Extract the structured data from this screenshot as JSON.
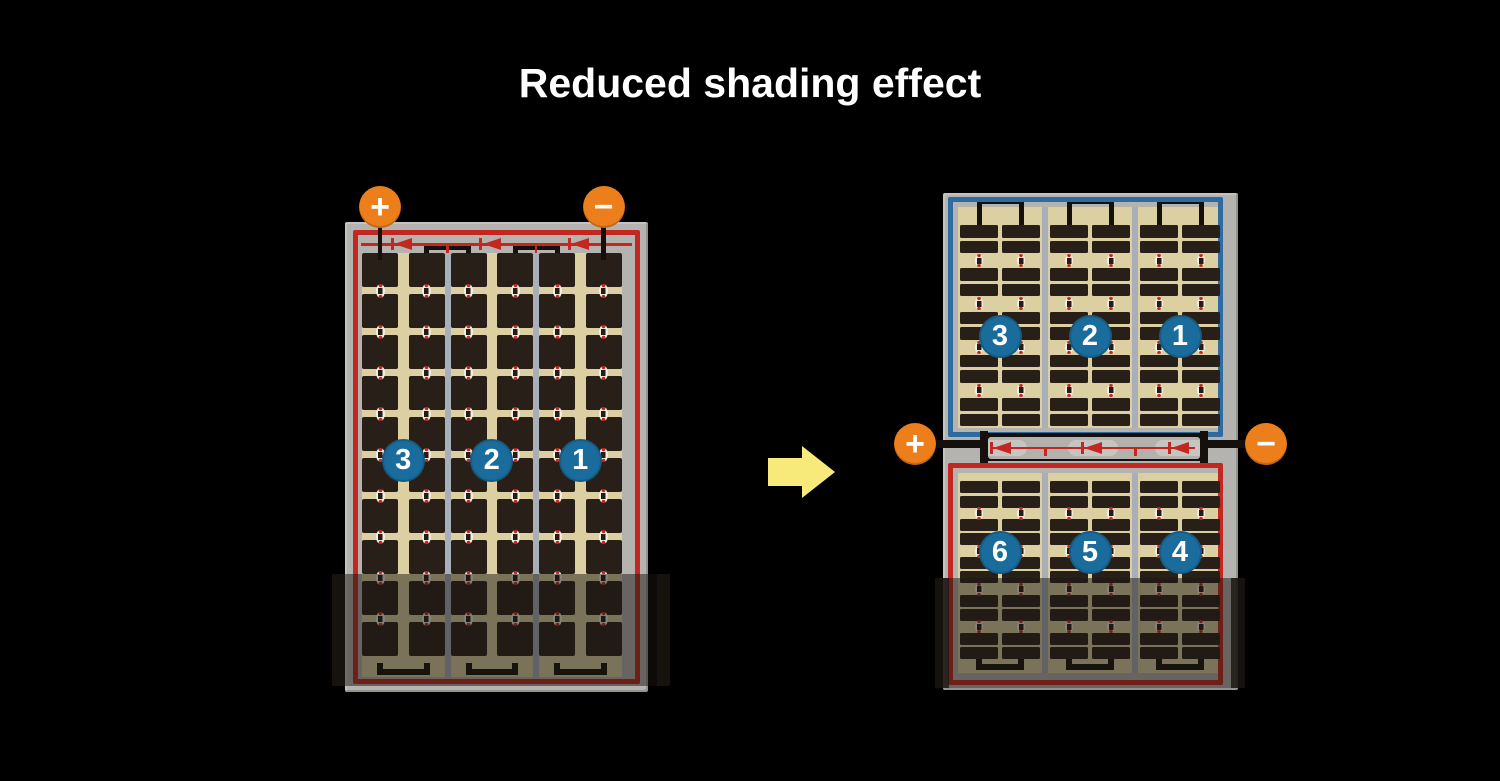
{
  "title": "Reduced shading effect",
  "colors": {
    "background": "#000000",
    "title_text": "#ffffff",
    "frame_gray": "#b5b3b0",
    "junction_gray": "#b3b1ae",
    "junction_module_gray": "#c7c5c2",
    "cell_area_tan": "#dccfa2",
    "cell_dark": "#281f18",
    "separator_gray": "#a9afb8",
    "circuit_red": "#c2281f",
    "circuit_blue": "#2d6ba0",
    "terminal_orange": "#ec7e1b",
    "terminal_text": "#ffffff",
    "badge_blue": "#1a6c9c",
    "badge_text": "#ffffff",
    "wire_black": "#15100c",
    "connector_white": "#f2eee2",
    "arrow_yellow": "#f8e97b",
    "shade": "rgba(25,21,18,0.5)",
    "shade_edge": "rgba(25,21,18,0.8)"
  },
  "left_module": {
    "terminals": [
      {
        "sign": "+"
      },
      {
        "sign": "−"
      }
    ],
    "strings": [
      {
        "label": "3"
      },
      {
        "label": "2"
      },
      {
        "label": "1"
      }
    ],
    "cell_grid": {
      "columns": 6,
      "rows": 10,
      "string_groups": 3
    },
    "bypass_diodes": 3,
    "partially_shaded": true
  },
  "right_module": {
    "terminals": [
      {
        "sign": "+"
      },
      {
        "sign": "−"
      }
    ],
    "top_half": {
      "border": "blue",
      "strings": [
        {
          "label": "3"
        },
        {
          "label": "2"
        },
        {
          "label": "1"
        }
      ],
      "cell_grid": {
        "columns": 6,
        "rows": 10,
        "string_groups": 3
      }
    },
    "bottom_half": {
      "border": "red",
      "strings": [
        {
          "label": "6"
        },
        {
          "label": "5"
        },
        {
          "label": "4"
        }
      ],
      "cell_grid": {
        "columns": 6,
        "rows": 10,
        "string_groups": 3
      }
    },
    "bypass_diodes": 3,
    "partially_shaded": true
  },
  "arrow": {
    "direction": "right"
  }
}
